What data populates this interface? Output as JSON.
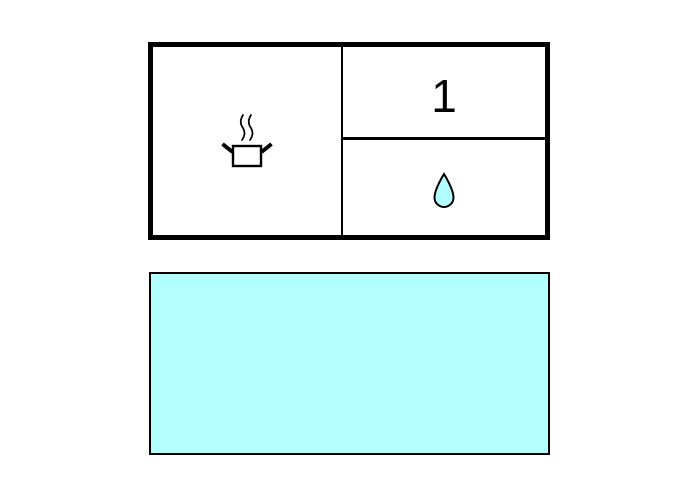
{
  "scene": {
    "background": "#ffffff"
  },
  "top_panel": {
    "cells": {
      "left": {
        "icon": "cooking-pot-with-steam"
      },
      "top_right": {
        "label": "1"
      },
      "bottom_right": {
        "icon": "water-droplet"
      }
    }
  },
  "bottom_panel": {
    "type": "filled-rectangle"
  },
  "colors": {
    "cyan_fill": "#b3ffff",
    "outline": "#000000"
  }
}
